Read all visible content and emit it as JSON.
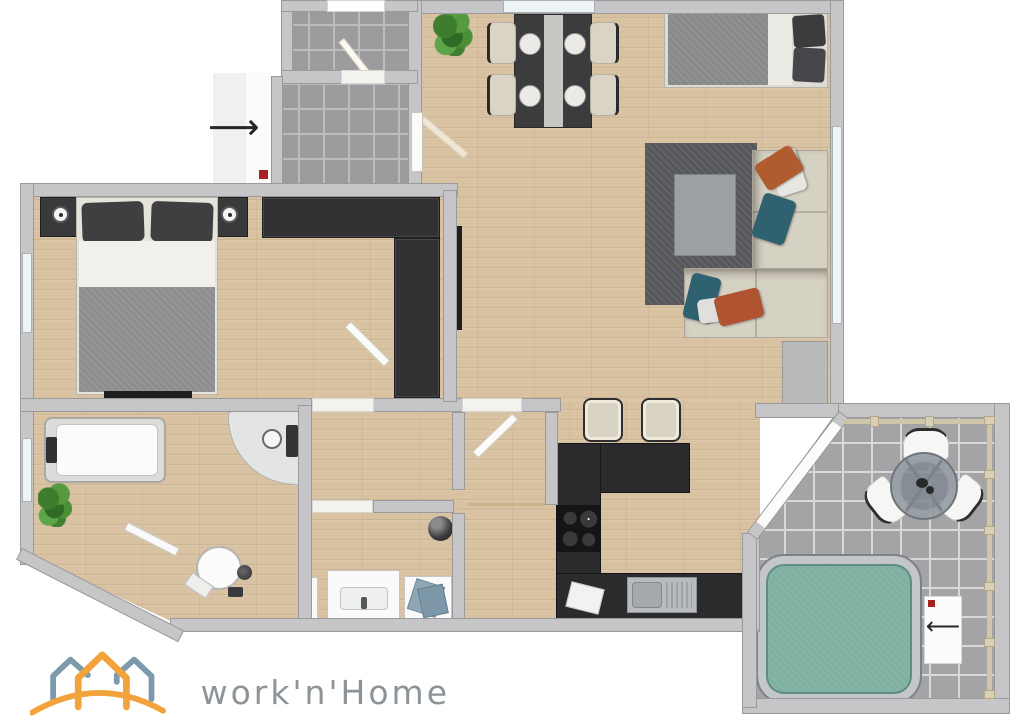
{
  "branding": {
    "logo_text": "work'n'Home"
  },
  "icons": {
    "entry_arrow": "⟶",
    "balcony_arrow": "⟵",
    "entry_marker": "red-square",
    "balcony_marker": "red-square",
    "logo_houses": "three-house-outlines-over-arc"
  },
  "palette": {
    "floor_wood": "#d8c2a2",
    "wall": "#c6c6c8",
    "tile_entry": "#9c9c9e",
    "tile_balcony": "#a4a4a6",
    "counter_dark": "#2b2b2d",
    "wardrobe_dark": "#323234",
    "rug": "#55575b",
    "sofa_beige": "#d5d1c3",
    "pillow_orange": "#b05c30",
    "pillow_teal": "#2f6170",
    "hot_tub_water": "#7fb0a2",
    "window_pane": "#eef3f5",
    "marker_red": "#a82222",
    "logo_orange": "#f2a33c",
    "logo_blue": "#7d99ac",
    "logo_text_color": "#8d9499"
  },
  "rooms": {
    "entry": [
      "stair-landing",
      "entry-hall-tiles",
      "landing-door",
      "apartment-door",
      "entry-direction-arrow",
      "entry-marker"
    ],
    "bedroom": [
      "headboard-panel",
      "wall-lamp-left",
      "wall-lamp-right",
      "double-bed",
      "pillows",
      "blanket",
      "wardrobe",
      "bedroom-tv"
    ],
    "living_dining": [
      "potted-plant",
      "dining-table",
      "dining-chairs-x4",
      "place-settings",
      "daybed",
      "area-rug",
      "coffee-table",
      "corner-sofa",
      "cushions",
      "living-tv",
      "sideboard",
      "bar-stools-x2"
    ],
    "kitchen": [
      "l-shaped-counter",
      "cooktop",
      "kitchen-sink",
      "utensils"
    ],
    "hallway": [
      "decor-sphere",
      "washbasin-cabinet",
      "towel-cabinet",
      "radiator"
    ],
    "bathroom": [
      "bathtub",
      "corner-shower",
      "toilet",
      "potted-plant",
      "radiator"
    ],
    "balcony": [
      "round-table",
      "outdoor-chairs-x3",
      "hot-tub",
      "railing",
      "balcony-door-label",
      "balcony-arrow",
      "balcony-marker"
    ]
  }
}
